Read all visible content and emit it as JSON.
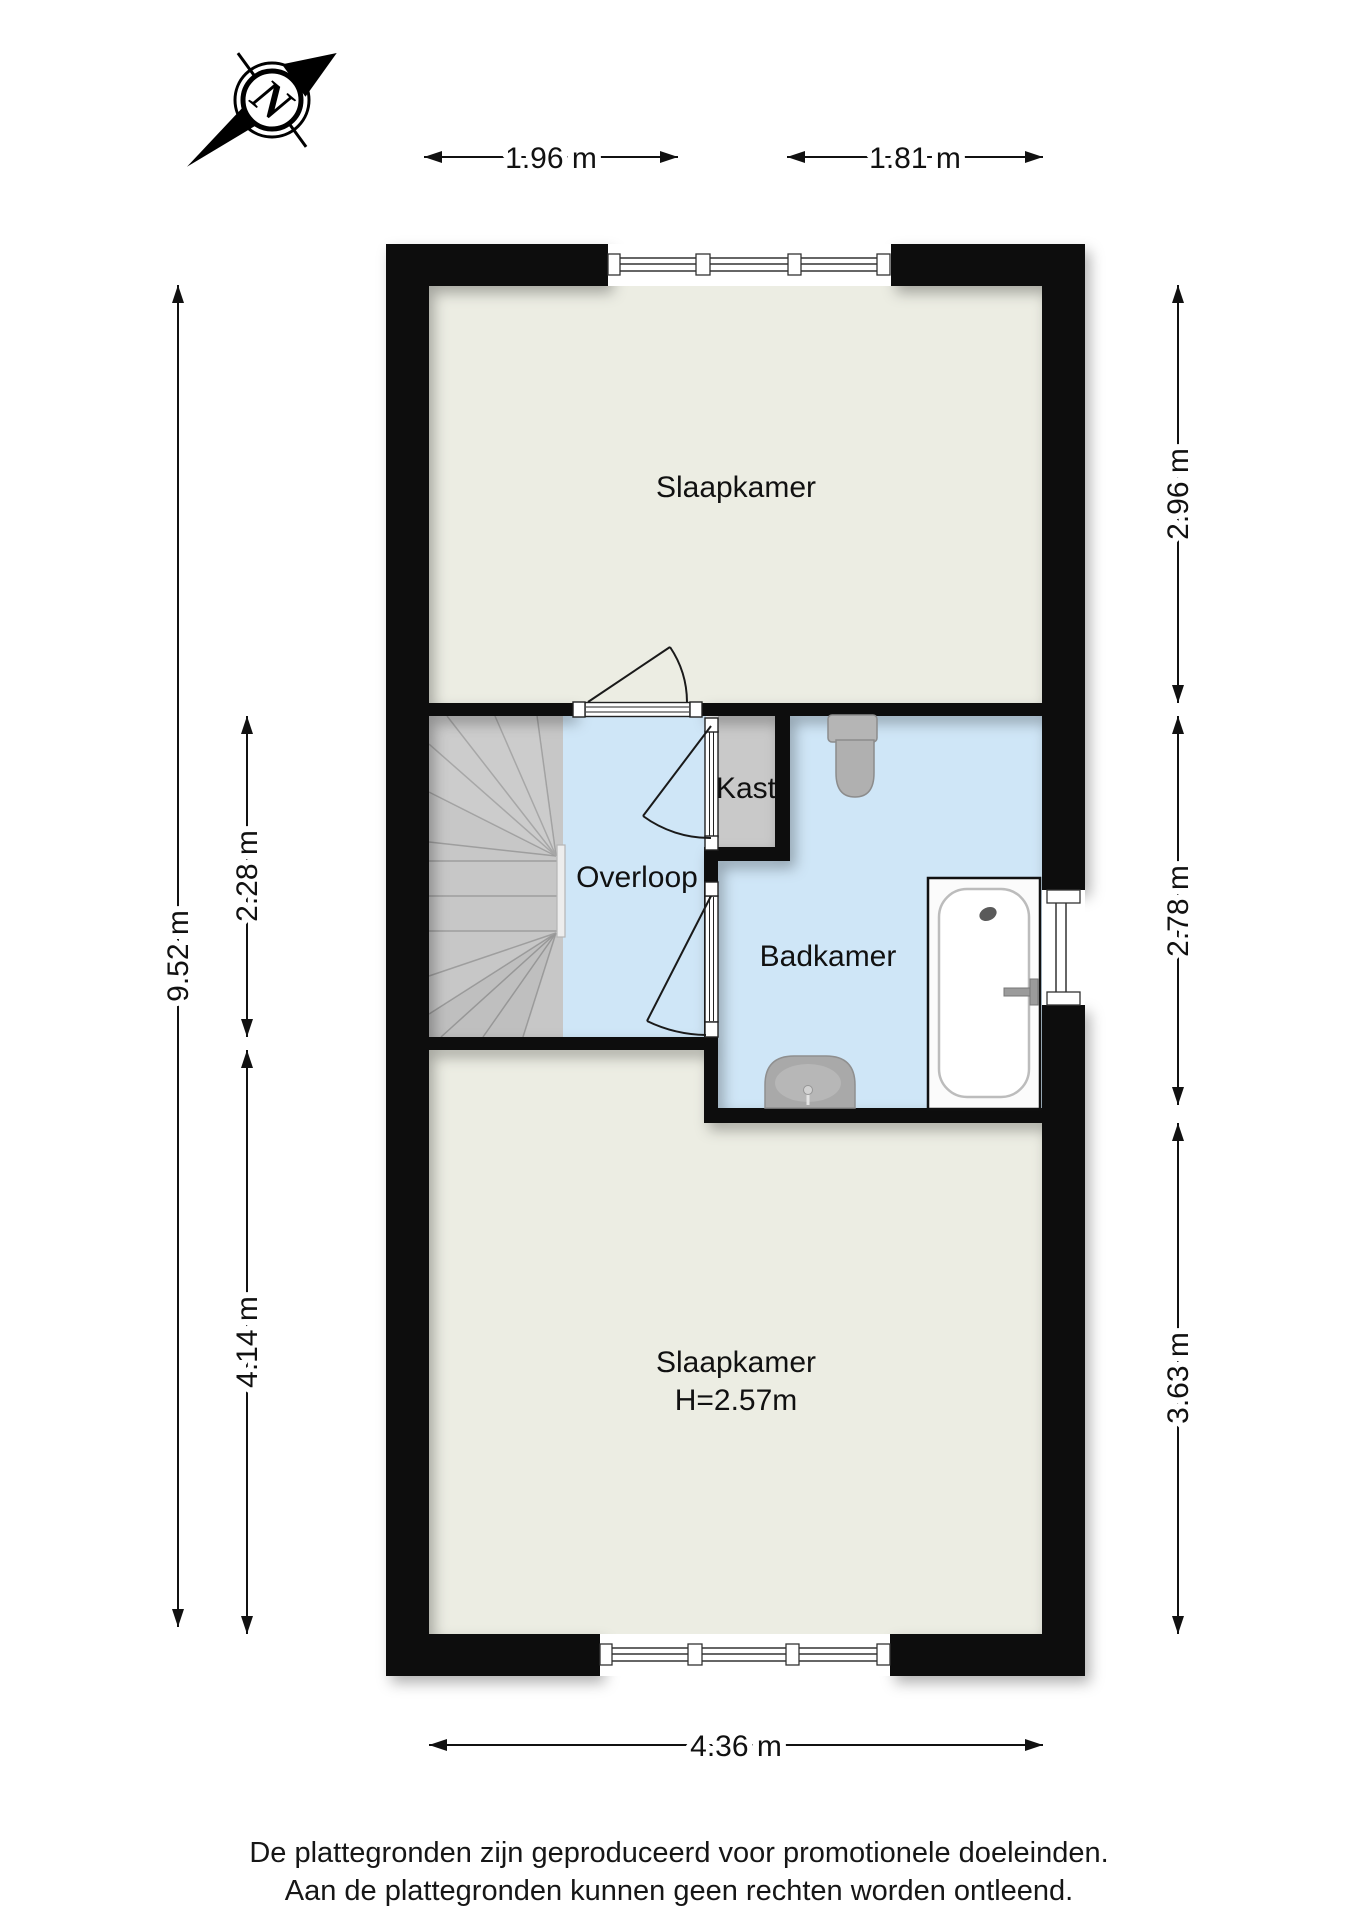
{
  "compass": {
    "letter": "N"
  },
  "rooms": {
    "slaapkamer_top": {
      "label": "Slaapkamer"
    },
    "overloop": {
      "label": "Overloop"
    },
    "kast": {
      "label": "Kast"
    },
    "badkamer": {
      "label": "Badkamer"
    },
    "slaapkamer_bottom": {
      "label": "Slaapkamer",
      "height": "H=2.57m"
    }
  },
  "dimensions": {
    "top_left": "1.96 m",
    "top_right": "1.81 m",
    "left_outer": "9.52 m",
    "left_middle": "2.28 m",
    "left_bottom": "4.14 m",
    "right_top": "2.96 m",
    "right_middle": "2.78 m",
    "right_bottom": "3.63 m",
    "bottom": "4.36 m"
  },
  "footer": {
    "line1": "De plattegronden zijn geproduceerd voor promotionele doeleinden.",
    "line2": "Aan de plattegronden kunnen geen rechten worden ontleend."
  },
  "colors": {
    "wall": "#0b0b0b",
    "floor_bedroom": "#ecede3",
    "floor_bathroom": "#cfe6f7",
    "floor_closet": "#c9c9c9",
    "stairs": "#c7c7c7",
    "fixture_gray": "#b5b5b5",
    "tub_white": "#fbfbfb"
  }
}
